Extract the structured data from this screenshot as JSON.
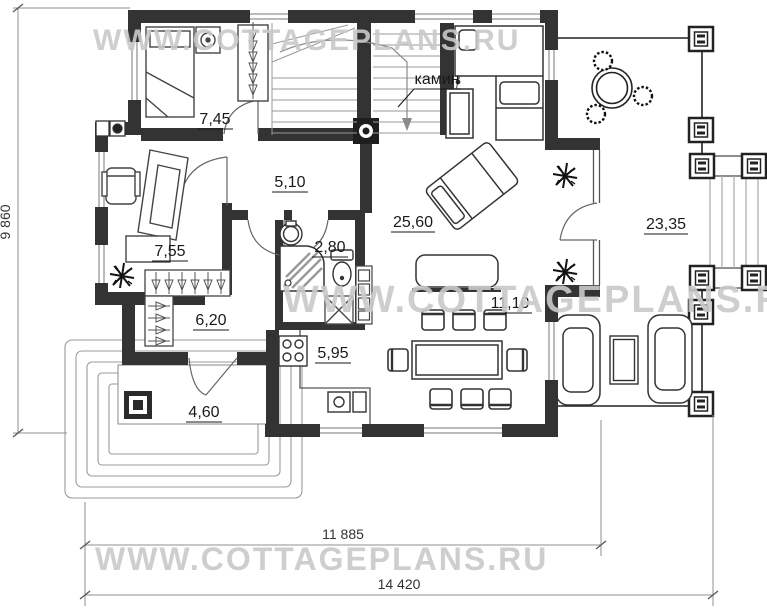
{
  "title": "Cottage first floor plan",
  "watermark": {
    "text": "WWW.COTTAGEPLANS.RU"
  },
  "rooms": [
    {
      "id": "bedroom",
      "area": "7,45"
    },
    {
      "id": "hall",
      "area": "5,10"
    },
    {
      "id": "study",
      "area": "7,55"
    },
    {
      "id": "bathroom",
      "area": "2,80"
    },
    {
      "id": "living",
      "area": "25,60"
    },
    {
      "id": "corridor",
      "area": "6,20"
    },
    {
      "id": "kitchen",
      "area": "5,95"
    },
    {
      "id": "porch",
      "area": "4,60"
    },
    {
      "id": "dining",
      "area": "11,10"
    },
    {
      "id": "terrace",
      "area": "23,35"
    }
  ],
  "annotations": {
    "fireplace": "камин"
  },
  "dimensions": {
    "left_height": "9 860",
    "bottom_inner_width": "11 885",
    "bottom_total_width": "14 420"
  },
  "colors": {
    "wall": "#333333",
    "furniture": "#4a4a4a",
    "thin": "#8f8f8f",
    "label": "#1a1a1a",
    "watermark": "#c9c9c9"
  }
}
